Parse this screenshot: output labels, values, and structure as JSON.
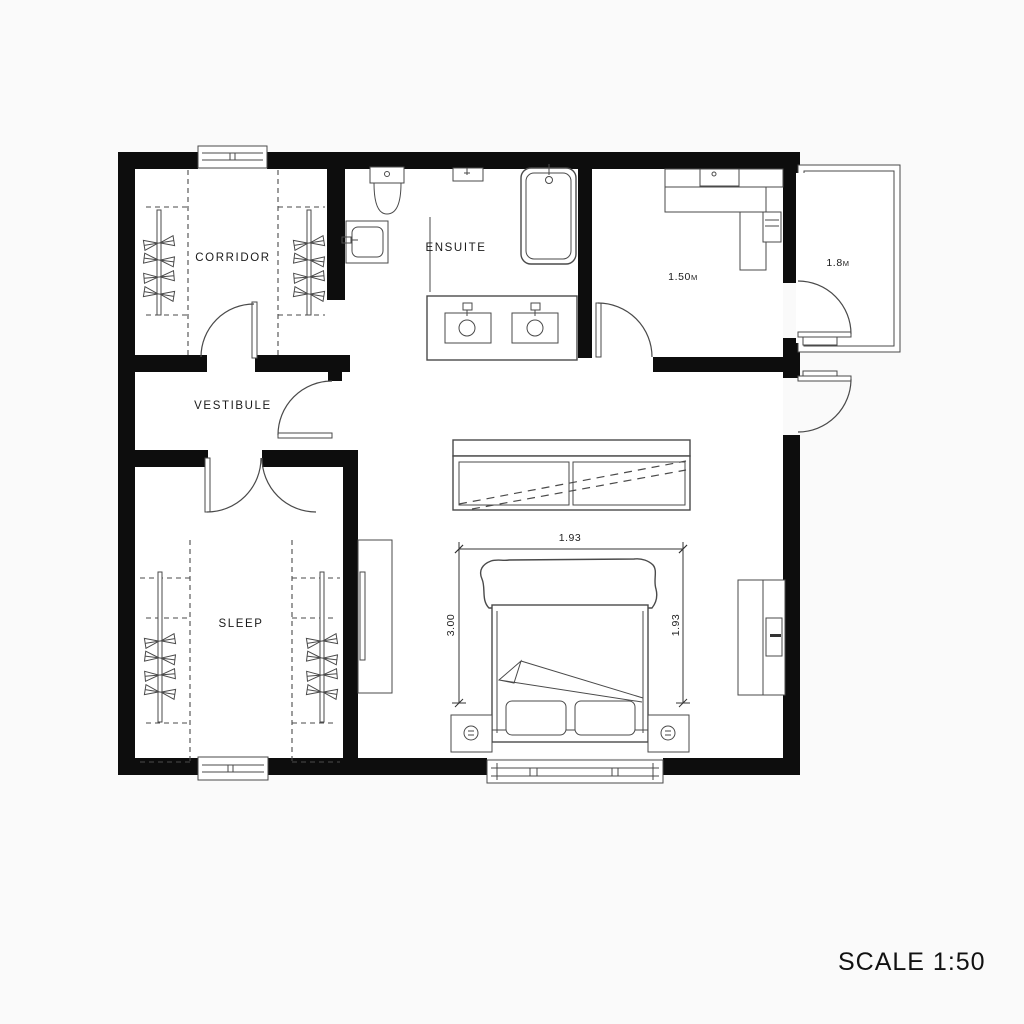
{
  "plan": {
    "rooms": [
      {
        "id": "corridor",
        "label": "CORRIDOR"
      },
      {
        "id": "vestibule",
        "label": "VESTIBULE"
      },
      {
        "id": "sleep",
        "label": "SLEEP"
      },
      {
        "id": "ensuite",
        "label": "ENSUITE"
      }
    ],
    "annotations": {
      "utility_value": "1.50",
      "utility_unit": "M",
      "balcony_value": "1.8",
      "balcony_unit": "M"
    },
    "dimensions": {
      "bed_width": "1.93",
      "bed_length_left": "3.00",
      "bed_length_right": "1.93"
    },
    "scale_label": "SCALE 1:50",
    "colors": {
      "wall": "#0d0d0d",
      "line": "#4a4a4a",
      "background": "#fafafa",
      "paper": "#ffffff"
    }
  }
}
